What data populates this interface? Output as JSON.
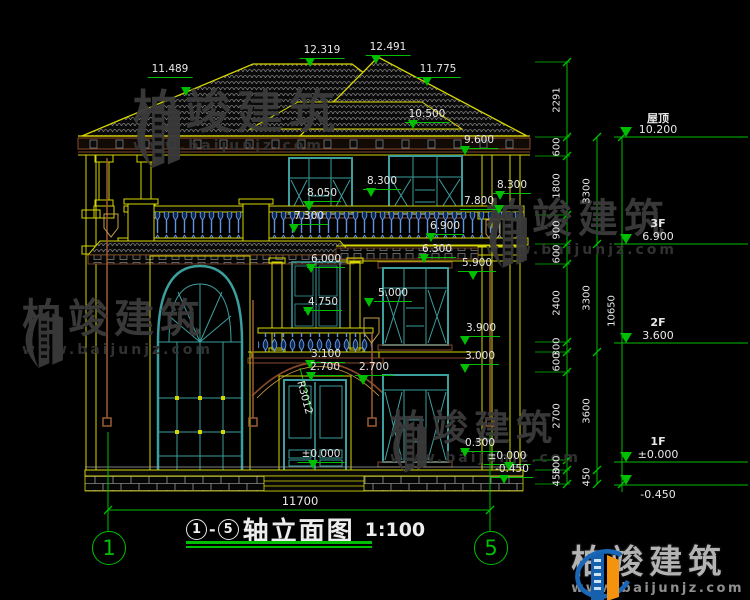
{
  "title_block": {
    "axis_from": "1",
    "separator": "-",
    "axis_to": "5",
    "name": "轴立面图",
    "scale": "1:100"
  },
  "axes": {
    "left": "1",
    "right": "5"
  },
  "bottom_dim": {
    "value": "11700"
  },
  "levels": [
    {
      "name": "屋顶",
      "value": "10.200",
      "y": 137
    },
    {
      "name": "3F",
      "value": "6.900",
      "y": 244
    },
    {
      "name": "2F",
      "value": "3.600",
      "y": 343
    },
    {
      "name": "1F",
      "value": "±0.000",
      "y": 462
    },
    {
      "name": "",
      "value": "-0.450",
      "y": 485,
      "below": true
    }
  ],
  "dim_chains": [
    {
      "x": 567,
      "ticks": [
        62,
        137,
        156,
        215,
        244,
        264,
        342,
        352,
        372,
        460,
        470,
        484
      ],
      "values": [
        "2291",
        "600",
        "1800",
        "900",
        "600",
        "2400",
        "300",
        "600",
        "2700",
        "300",
        "450"
      ],
      "ext": true
    },
    {
      "x": 597,
      "ticks": [
        137,
        244,
        352,
        470,
        484
      ],
      "values": [
        "3300",
        "3300",
        "3600",
        "450"
      ]
    },
    {
      "x": 622,
      "ticks": [
        137,
        484
      ],
      "values": [
        "10650"
      ]
    }
  ],
  "elevation_labels": [
    {
      "t": "11.489",
      "x": 170,
      "y": 64,
      "mx": 186,
      "my": 96
    },
    {
      "t": "12.319",
      "x": 322,
      "y": 45,
      "mx": 310,
      "my": 67
    },
    {
      "t": "12.491",
      "x": 388,
      "y": 42,
      "mx": 376,
      "my": 64
    },
    {
      "t": "11.775",
      "x": 438,
      "y": 64,
      "mx": 427,
      "my": 86
    },
    {
      "t": "10.500",
      "x": 427,
      "y": 109,
      "mx": 413,
      "my": 129
    },
    {
      "t": "9.600",
      "x": 479,
      "y": 135,
      "mx": 465,
      "my": 155
    },
    {
      "t": "8.300",
      "x": 382,
      "y": 176,
      "mx": 371,
      "my": 197
    },
    {
      "t": "8.300",
      "x": 512,
      "y": 180,
      "mx": 500,
      "my": 200
    },
    {
      "t": "8.050",
      "x": 322,
      "y": 188,
      "mx": 309,
      "my": 211
    },
    {
      "t": "7.800",
      "x": 479,
      "y": 196,
      "mx": 499,
      "my": 214
    },
    {
      "t": "7.300",
      "x": 309,
      "y": 211,
      "mx": 294,
      "my": 233
    },
    {
      "t": "6.900",
      "x": 445,
      "y": 221,
      "mx": 431,
      "my": 242
    },
    {
      "t": "6.300",
      "x": 437,
      "y": 244,
      "mx": 424,
      "my": 263
    },
    {
      "t": "6.000",
      "x": 326,
      "y": 254,
      "mx": 311,
      "my": 273
    },
    {
      "t": "5.900",
      "x": 477,
      "y": 258,
      "mx": 473,
      "my": 280
    },
    {
      "t": "5.000",
      "x": 393,
      "y": 288,
      "mx": 369,
      "my": 307
    },
    {
      "t": "4.750",
      "x": 323,
      "y": 297,
      "mx": 308,
      "my": 316
    },
    {
      "t": "3.900",
      "x": 481,
      "y": 323,
      "mx": 465,
      "my": 345
    },
    {
      "t": "3.100",
      "x": 326,
      "y": 349,
      "mx": 310,
      "my": 369
    },
    {
      "t": "2.700",
      "x": 325,
      "y": 362,
      "mx": 311,
      "my": 381
    },
    {
      "t": "2.700",
      "x": 374,
      "y": 362,
      "mx": 363,
      "my": 385
    },
    {
      "t": "3.000",
      "x": 480,
      "y": 351,
      "mx": 465,
      "my": 373
    },
    {
      "t": "0.300",
      "x": 480,
      "y": 438,
      "mx": 465,
      "my": 457
    },
    {
      "t": "±0.000",
      "x": 321,
      "y": 449,
      "mx": 313,
      "my": 469
    },
    {
      "t": "±0.000",
      "x": 507,
      "y": 451,
      "mx": 509,
      "my": 471
    },
    {
      "t": "-0.450",
      "x": 512,
      "y": 464,
      "mx": 504,
      "my": 484
    },
    {
      "t": "R3012",
      "x": 304,
      "y": 376,
      "rot": 75
    }
  ],
  "watermark": {
    "text": "柏竣建筑",
    "url": "www.baijunjz.com",
    "positions": [
      {
        "x": 133,
        "y": 88,
        "fs": 46
      },
      {
        "x": 22,
        "y": 298,
        "fs": 40
      },
      {
        "x": 486,
        "y": 198,
        "fs": 40
      },
      {
        "x": 390,
        "y": 410,
        "fs": 36
      }
    ]
  },
  "logo": {
    "text": "柏竣建筑",
    "url": "www.baijunjz.com"
  }
}
